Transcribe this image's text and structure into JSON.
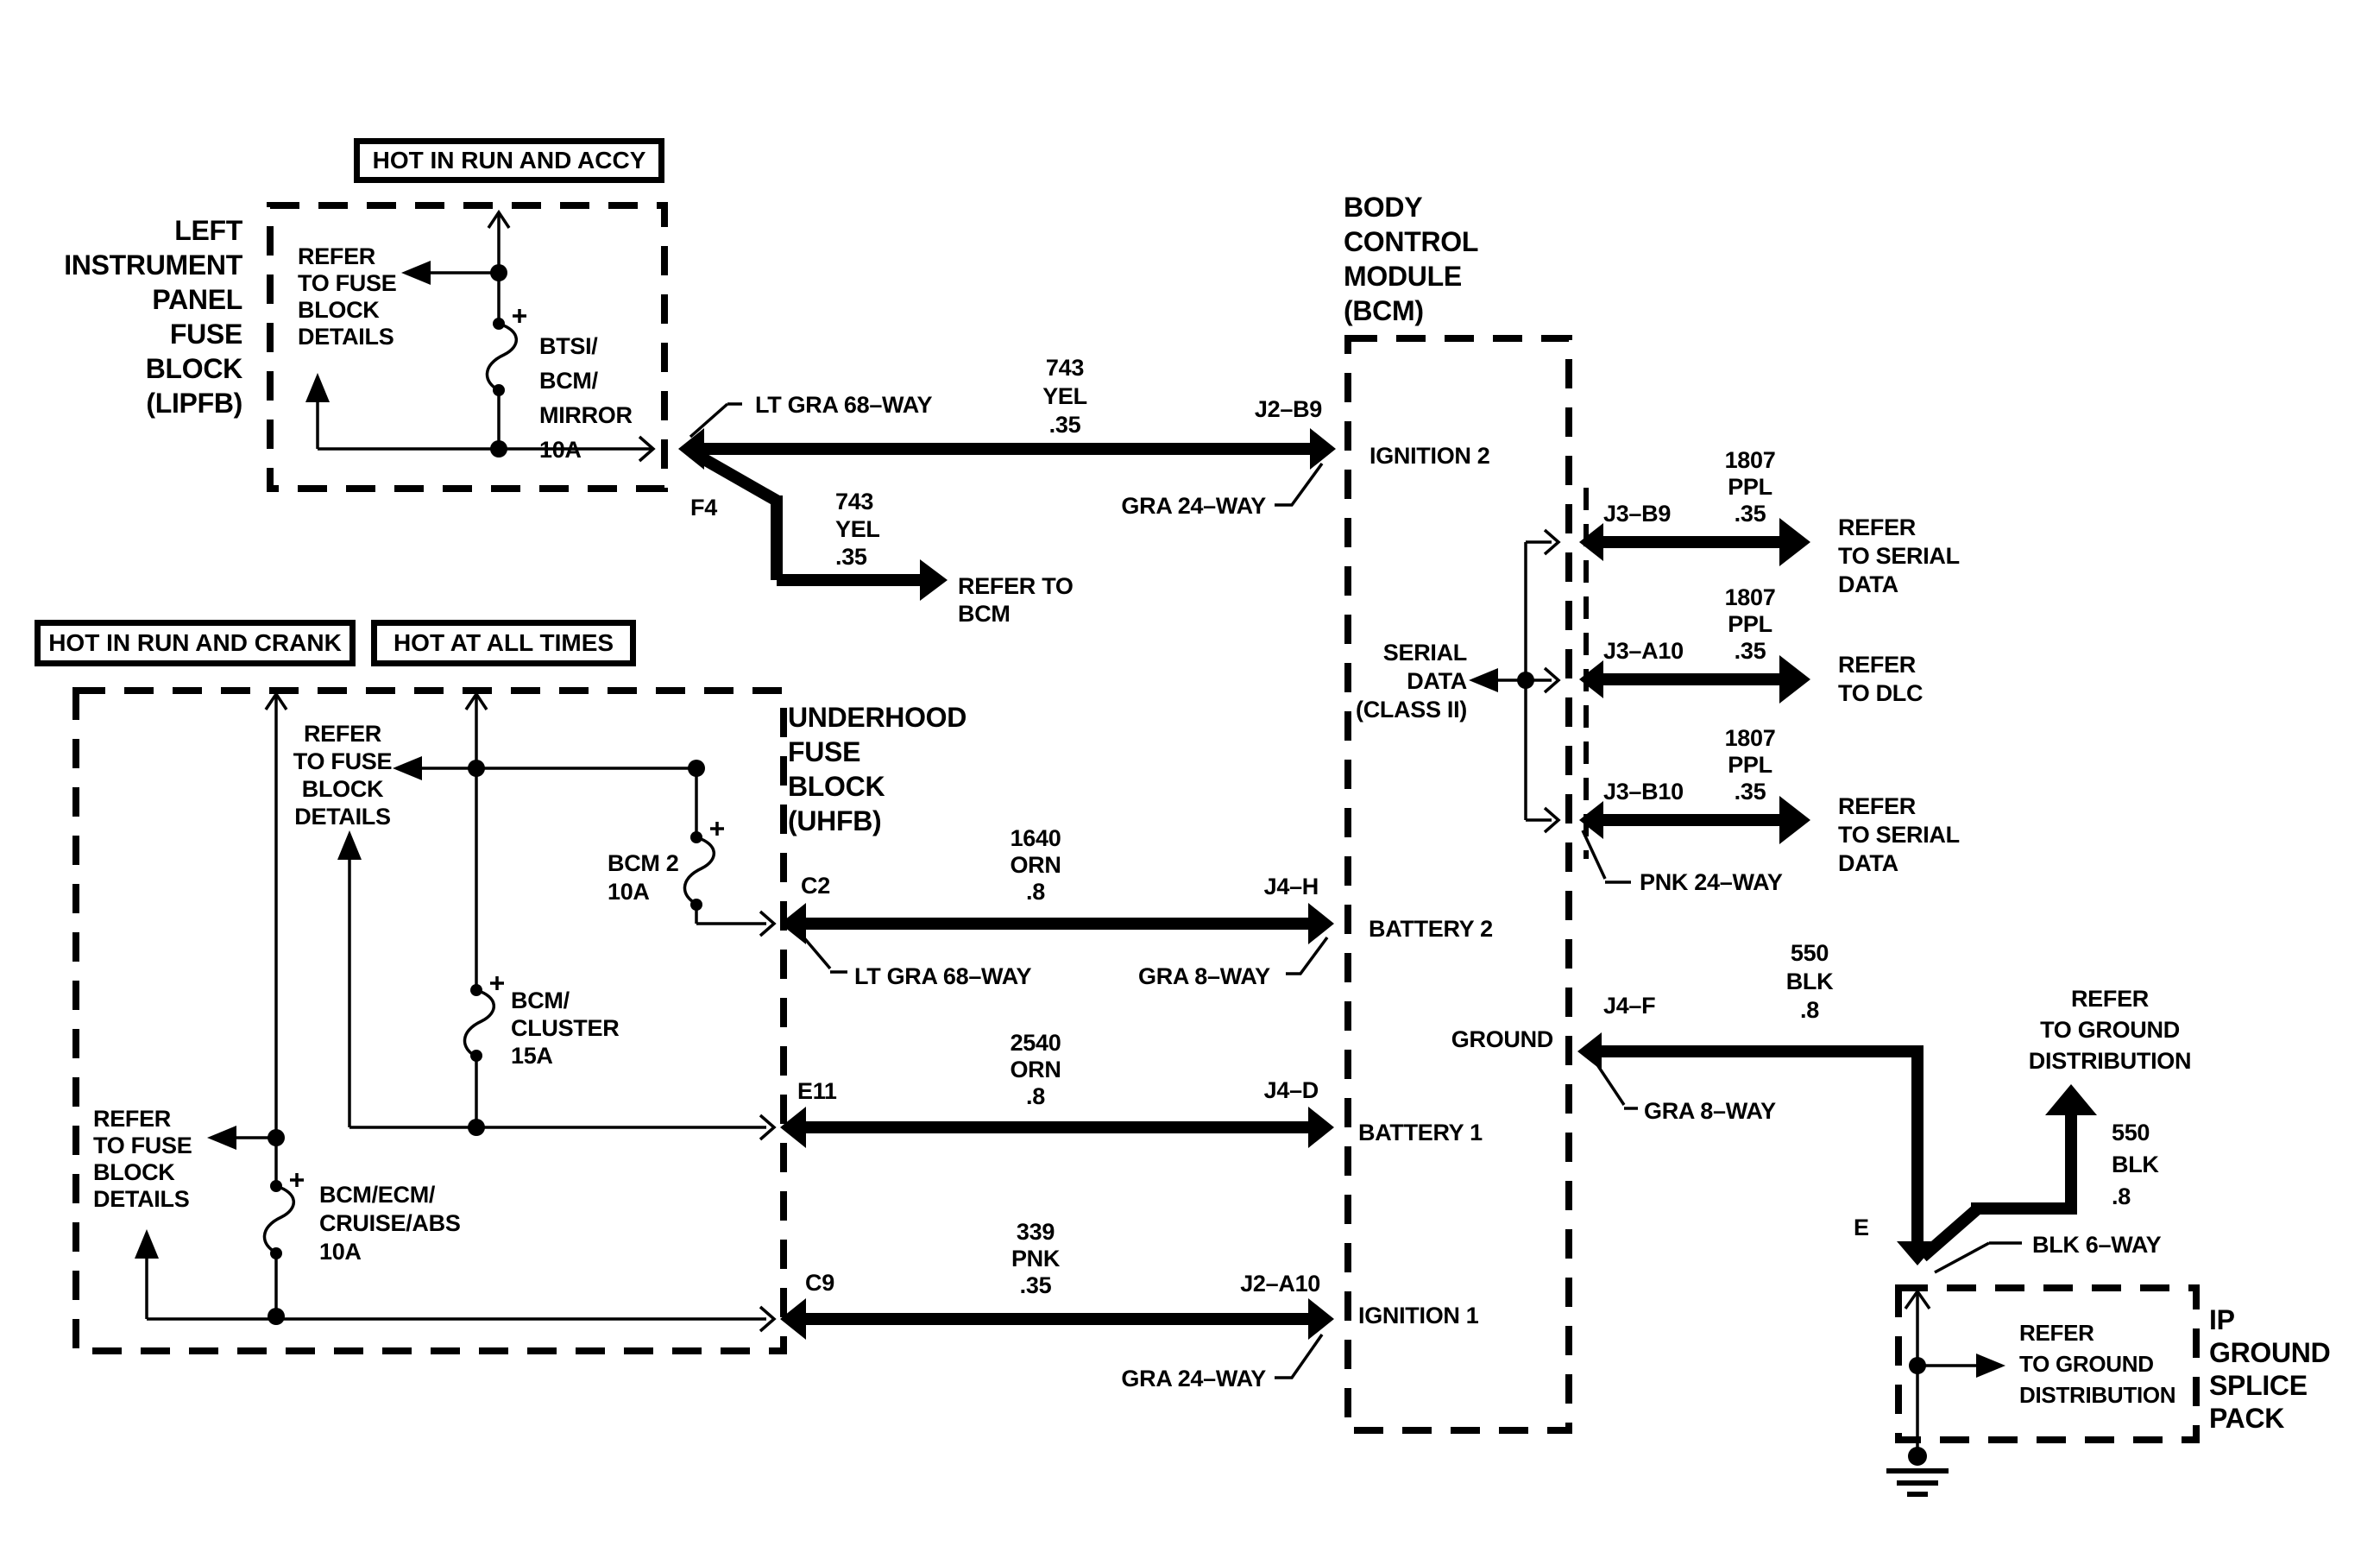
{
  "colors": {
    "ink": "#000000",
    "paper": "#ffffff"
  },
  "banners": {
    "hot_in_run_and_accy": "HOT IN RUN AND ACCY",
    "hot_in_run_and_crank": "HOT IN RUN AND CRANK",
    "hot_at_all_times": "HOT AT ALL TIMES"
  },
  "lipfb": {
    "title": "LEFT\nINSTRUMENT\nPANEL\nFUSE\nBLOCK\n(LIPFB)",
    "refer": "REFER\nTO FUSE\nBLOCK\nDETAILS",
    "fuse_btsi": "BTSI/\nBCM/\nMIRROR\n10A"
  },
  "uhfb": {
    "title": "UNDERHOOD\nFUSE\nBLOCK\n(UHFB)",
    "refer_top": "REFER\nTO FUSE\nBLOCK\nDETAILS",
    "refer_left": "REFER\nTO FUSE\nBLOCK\nDETAILS",
    "fuse_bcm2": "BCM 2\n10A",
    "fuse_bcm_cluster": "BCM/\nCLUSTER\n15A",
    "fuse_bcm_ecm": "BCM/ECM/\nCRUISE/ABS\n10A"
  },
  "bcm": {
    "title": "BODY\nCONTROL\nMODULE\n(BCM)",
    "ignition2": "IGNITION 2",
    "serial_data": "SERIAL\nDATA\n(CLASS II)",
    "battery2": "BATTERY 2",
    "ground": "GROUND",
    "battery1": "BATTERY 1",
    "ignition1": "IGNITION 1"
  },
  "ip_splice": {
    "title": "IP\nGROUND\nSPLICE\nPACK",
    "refer": "REFER\nTO GROUND\nDISTRIBUTION"
  },
  "wires": {
    "ignition2": {
      "pin": "F4",
      "connector": "LT GRA 68–WAY",
      "circuit": "743\nYEL\n.35",
      "branch_circuit": "743\nYEL\n.35",
      "branch_dest": "REFER TO\nBCM",
      "bcm_pin": "J2–B9",
      "bcm_connector": "GRA 24–WAY"
    },
    "battery2": {
      "pin": "C2",
      "connector": "LT GRA 68–WAY",
      "circuit": "1640\nORN\n.8",
      "bcm_pin": "J4–H",
      "bcm_connector": "GRA 8–WAY"
    },
    "battery1": {
      "pin": "E11",
      "circuit": "2540\nORN\n.8",
      "bcm_pin": "J4–D"
    },
    "ignition1": {
      "pin": "C9",
      "circuit": "339\nPNK\n.35",
      "bcm_pin": "J2–A10",
      "bcm_connector": "GRA 24–WAY"
    },
    "serial_b9": {
      "bcm_pin": "J3–B9",
      "circuit": "1807\nPPL\n.35",
      "dest": "REFER\nTO SERIAL\nDATA"
    },
    "serial_a10": {
      "bcm_pin": "J3–A10",
      "circuit": "1807\nPPL\n.35",
      "dest": "REFER\nTO DLC"
    },
    "serial_b10": {
      "bcm_pin": "J3–B10",
      "circuit": "1807\nPPL\n.35",
      "dest": "REFER\nTO SERIAL\nDATA",
      "connector": "PNK 24–WAY"
    },
    "ground": {
      "bcm_pin": "J4–F",
      "connector": "GRA 8–WAY",
      "circuit": "550\nBLK\n.8",
      "branch_circuit": "550\nBLK\n.8",
      "branch_dest": "REFER\nTO GROUND\nDISTRIBUTION",
      "splice_pin": "E",
      "splice_connector": "BLK 6–WAY"
    }
  }
}
